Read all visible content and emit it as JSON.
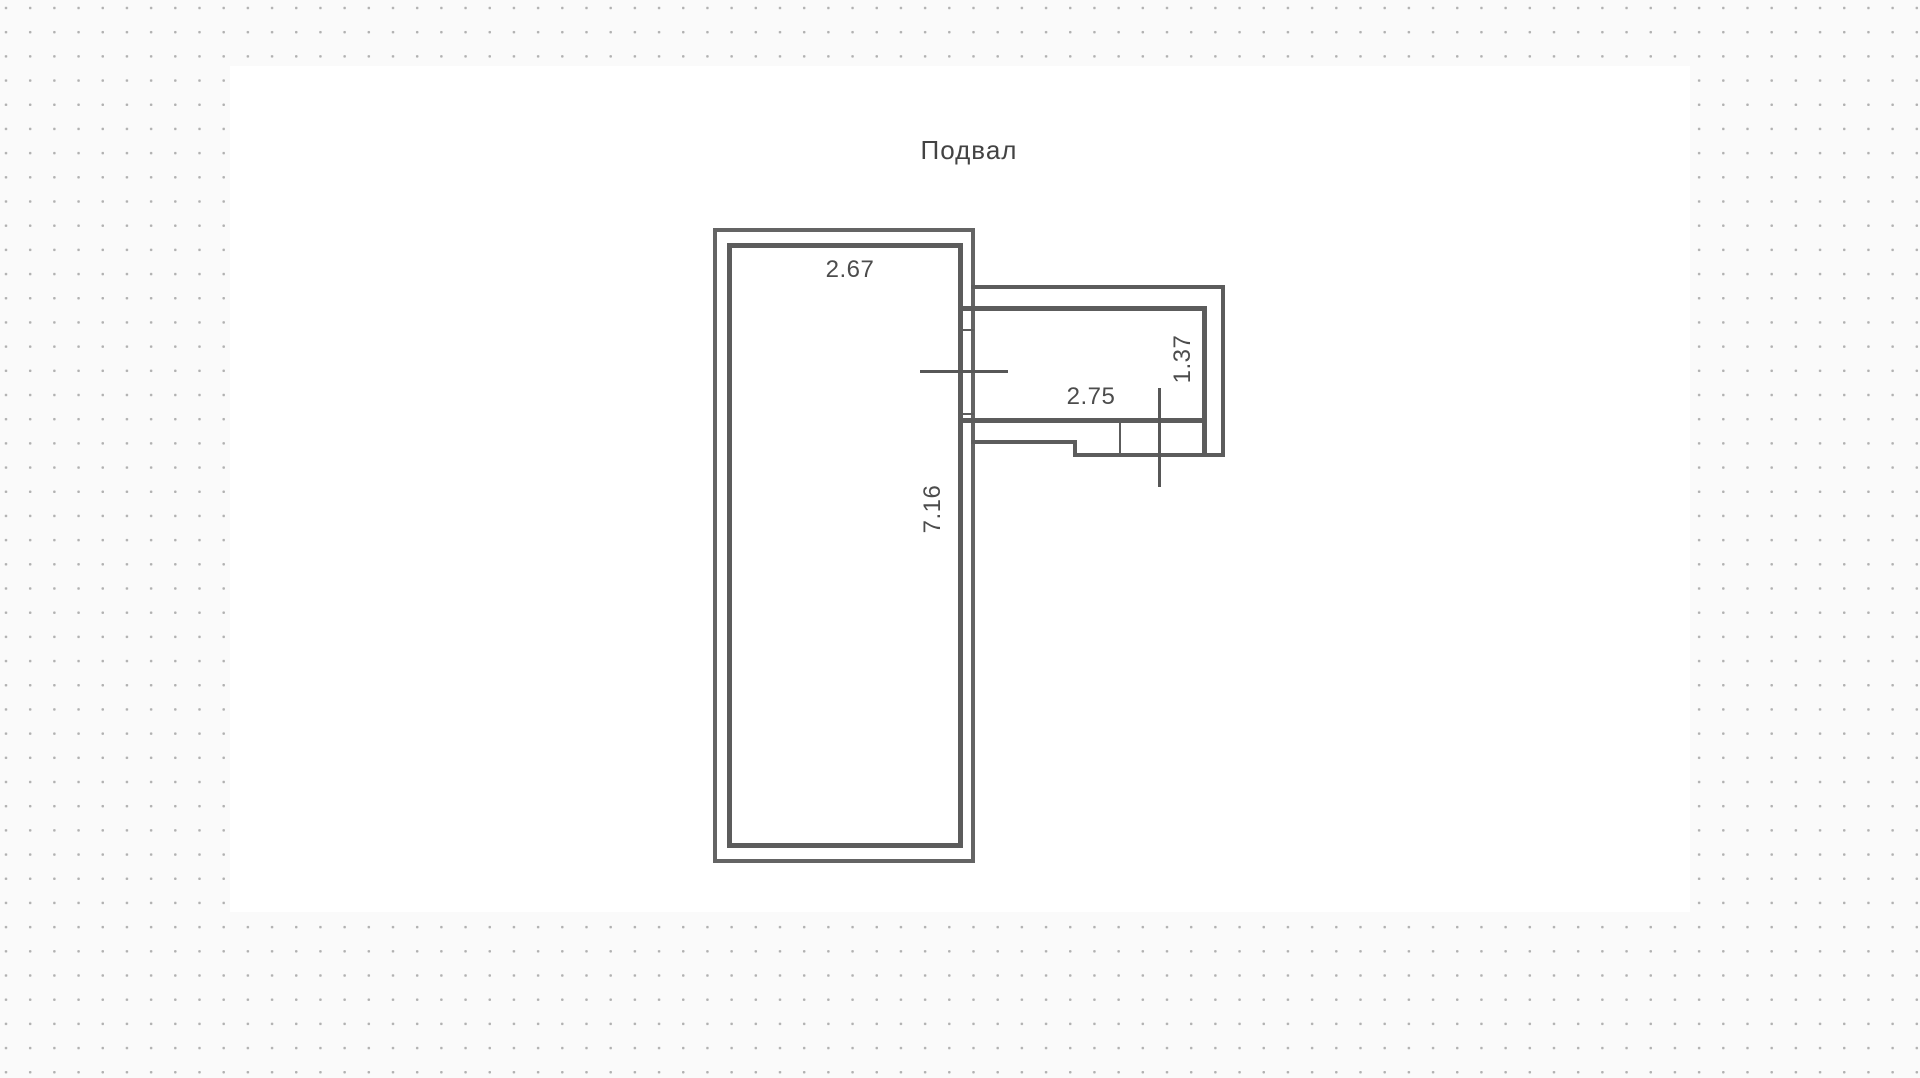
{
  "canvas": {
    "backdrop_color": "#fafafa",
    "dot_color": "#b1b1b1",
    "surface_color": "#ffffff",
    "wall_color": "#5c5c5c",
    "label_color": "#4c4c4c"
  },
  "plan": {
    "title": "Подвал",
    "rooms": {
      "main_room": {
        "width_m": "2.67",
        "depth_m": "7.16"
      },
      "annex": {
        "width_m": "2.75",
        "depth_m": "1.37"
      }
    }
  }
}
